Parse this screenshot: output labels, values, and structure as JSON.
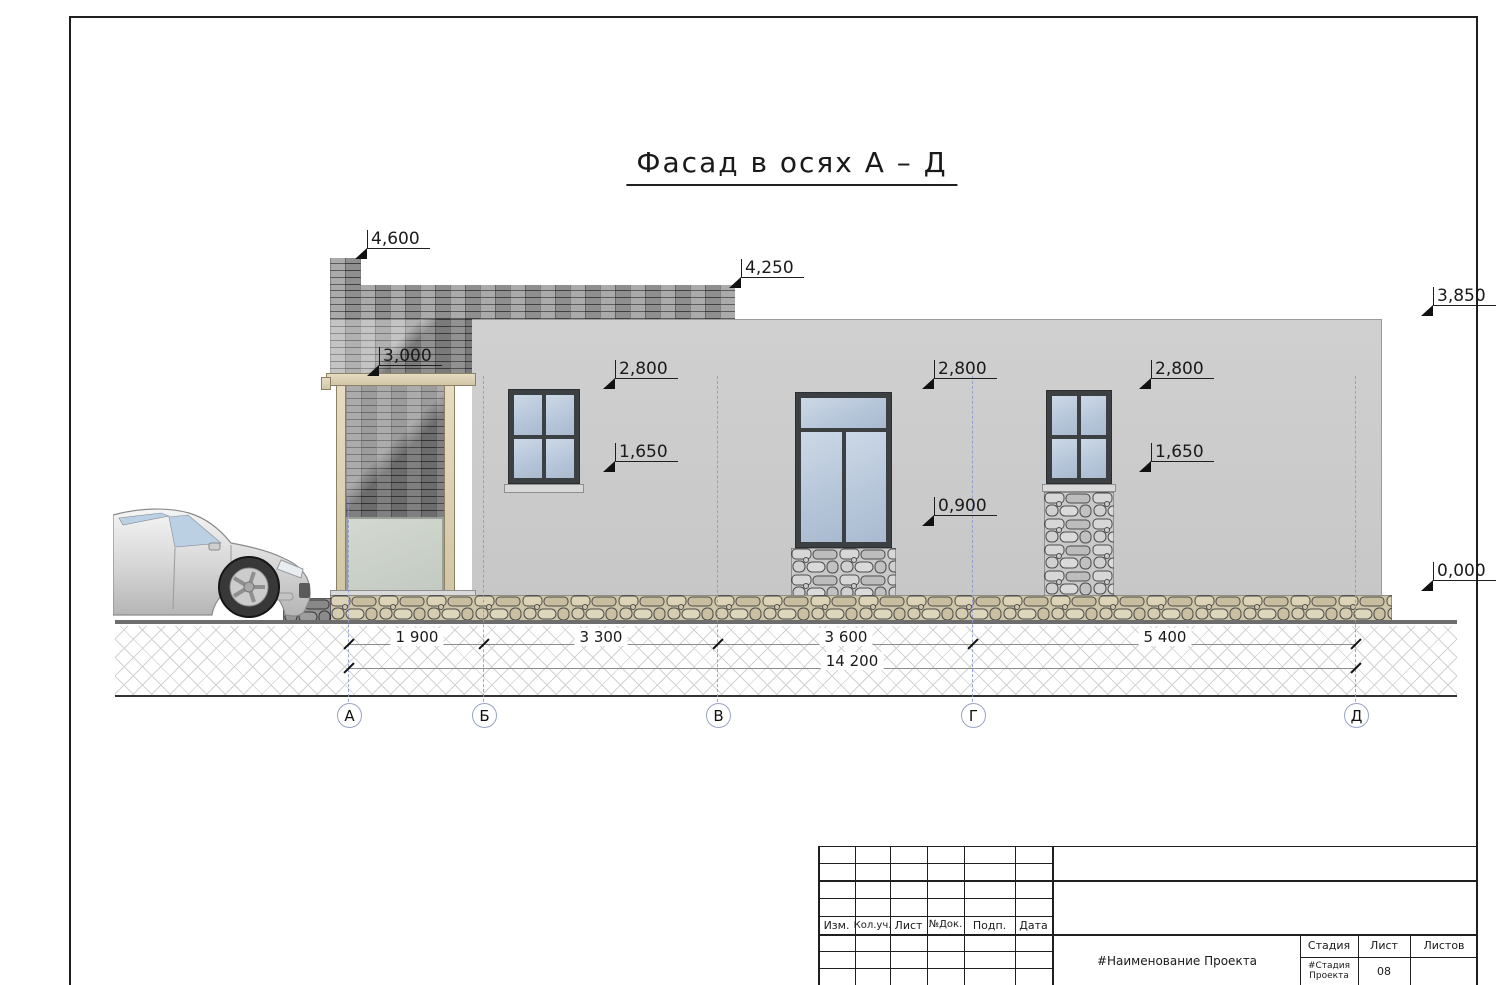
{
  "sheet_title": "Фасад в осях А – Д",
  "elevations": {
    "top_chimney": "4,600",
    "top_parapet": "4,250",
    "top_wall": "3,850",
    "pergola": "3,000",
    "window_head_1": "2,800",
    "window_head_2": "2,800",
    "window_head_3": "2,800",
    "window_sill_1": "1,650",
    "window_sill_3": "1,650",
    "window_sill_2": "0,900",
    "ground": "0,000"
  },
  "dimensions": {
    "seg_ab": "1 900",
    "seg_bv": "3 300",
    "seg_vg": "3 600",
    "seg_gd": "5 400",
    "total": "14 200"
  },
  "axes": {
    "a": "А",
    "b": "Б",
    "v": "В",
    "g": "Г",
    "d": "Д"
  },
  "title_block": {
    "col_izm": "Изм.",
    "col_koluch": "Кол.уч.",
    "col_list": "Лист",
    "col_ndok": "№Док.",
    "col_podp": "Подп.",
    "col_data": "Дата",
    "project_name": "#Наименование Проекта",
    "stage_label": "Стадия",
    "sheet_label": "Лист",
    "sheets_label": "Листов",
    "stage_value": "#Стадия Проекта",
    "sheet_number": "08",
    "sheets_value": ""
  },
  "colors": {
    "axis_dash": "#8f99cc",
    "wall": "#cdcdcd",
    "brick": "#9f9f9f",
    "glass": "#b9c6d9",
    "stone_tan": "#cfc5a8",
    "stone_gray": "#c9c9c9"
  }
}
